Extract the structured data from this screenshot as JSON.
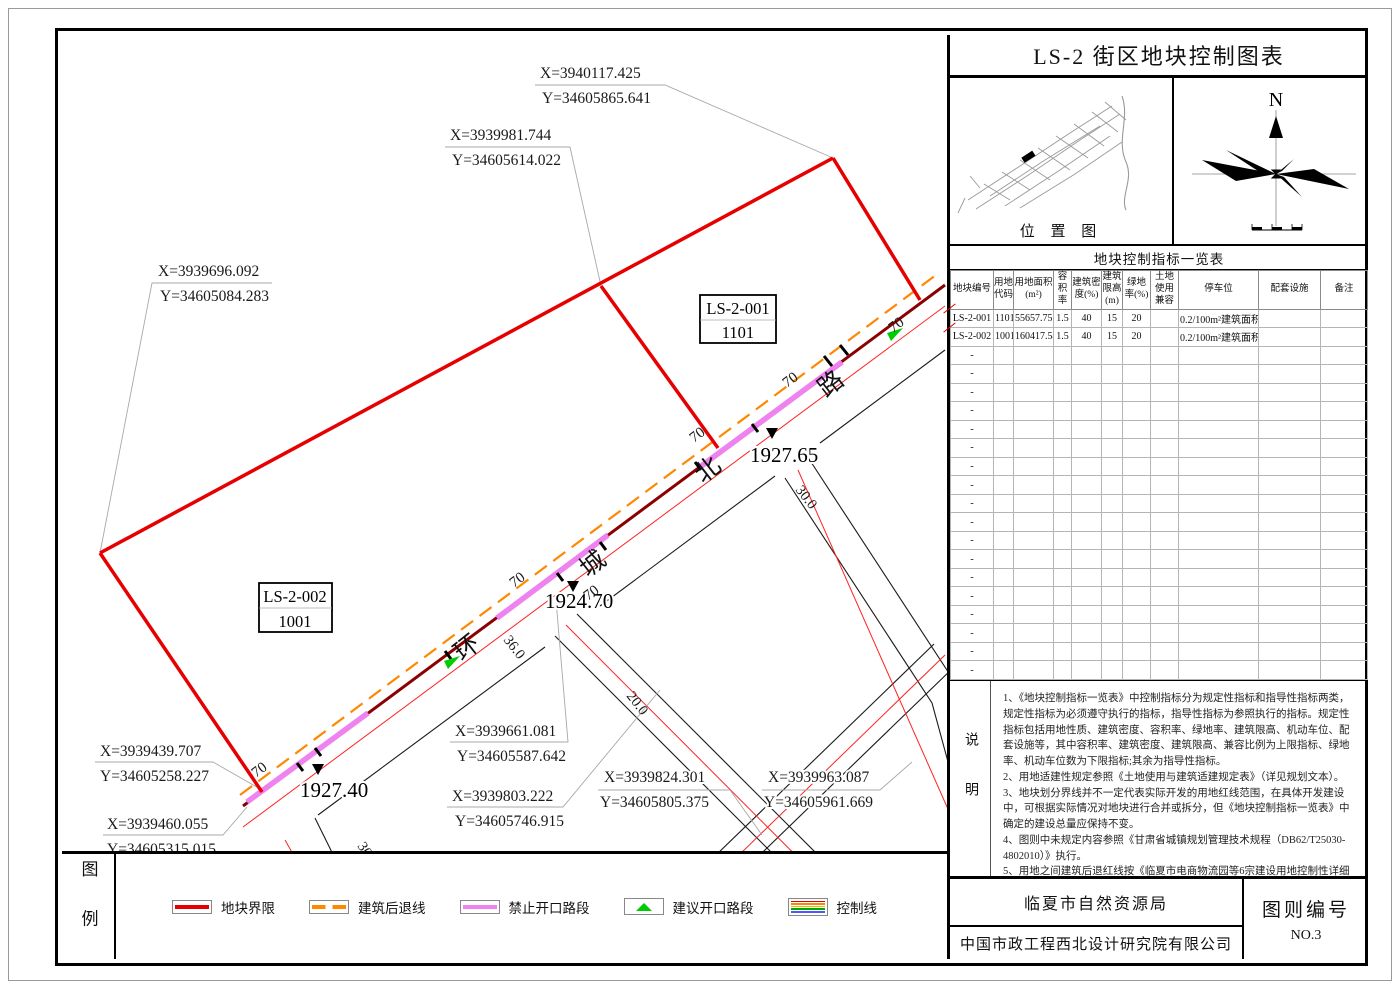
{
  "sheet": {
    "title": "LS-2 街区地块控制图表",
    "location_label": "位 置 图",
    "north_label": "N",
    "table_title": "地块控制指标一览表"
  },
  "table": {
    "headers": [
      "地块编号",
      "用地代码",
      "用地面积(m²)",
      "容积率",
      "建筑密度(%)",
      "建筑限高(m)",
      "绿地率(%)",
      "土地使用兼容",
      "停车位",
      "配套设施",
      "备注"
    ],
    "rows": [
      [
        "LS-2-001",
        "1101",
        "55657.75",
        "1.5",
        "40",
        "15",
        "20",
        "",
        "0.2/100m²建筑面积",
        "",
        ""
      ],
      [
        "LS-2-002",
        "1001",
        "160417.54",
        "1.5",
        "40",
        "15",
        "20",
        "",
        "0.2/100m²建筑面积",
        "",
        ""
      ]
    ],
    "empty_row_count": 18,
    "empty_placeholder": "-"
  },
  "notes": {
    "label": "说明",
    "lines": [
      "1、《地块控制指标一览表》中控制指标分为规定性指标和指导性指标两类，规定性指标为必须遵守执行的指标，指导性指标为参照执行的指标。规定性指标包括用地性质、建筑密度、容积率、绿地率、建筑限高、机动车位、配套设施等，其中容积率、建筑密度、建筑限高、兼容比例为上限指标、绿地率、机动车位数为下限指标;其余为指导性指标。",
      "2、用地适建性规定参照《土地使用与建筑适建规定表》（详见规划文本）。",
      "3、地块划分界线并不一定代表实际开发的用地红线范围，在具体开发建设中，可根据实际情况对地块进行合并或拆分，但《地块控制指标一览表》中确定的建设总量应保持不变。",
      "4、图则中未规定内容参照《甘肃省城镇规划管理技术规程（DB62/T25030-4802010）》执行。",
      "5、用地之间建筑后退红线按《临夏市电商物流园等6宗建设用地控制性详细规划》具体要求执行",
      "6、城市设计指引：建筑色彩在整体和谐的前提下，鼓励各单体建筑局部色彩多样化。",
      "工业建筑",
      "色彩要求素雅明快，强调环境色彩的和谐统一。",
      "基本色：以高明度、低饱和度的色系为主。",
      "辅助色：适当增加高明度、中饱和度的暖色调或冷灰色调。",
      "点缀色：增加色彩的变化，提高色彩的饱和度。"
    ]
  },
  "title_block": {
    "agency": "临夏市自然资源局",
    "company": "中国市政工程西北设计研究院有限公司",
    "sheet_no_label": "图则编号",
    "sheet_no": "NO.3"
  },
  "legend": {
    "label": "图例",
    "items": [
      {
        "label": "地块界限"
      },
      {
        "label": "建筑后退线"
      },
      {
        "label": "禁止开口路段"
      },
      {
        "label": "建议开口路段"
      },
      {
        "label": "控制线"
      }
    ]
  },
  "map": {
    "parcels": [
      {
        "id": "LS-2-001",
        "code": "1101"
      },
      {
        "id": "LS-2-002",
        "code": "1001"
      }
    ],
    "road_name": [
      "环",
      "城",
      "北",
      "路"
    ],
    "coordinates": [
      {
        "x": "X=3940117.425",
        "y": "Y=34605865.641"
      },
      {
        "x": "X=3939981.744",
        "y": "Y=34605614.022"
      },
      {
        "x": "X=3939696.092",
        "y": "Y=34605084.283"
      },
      {
        "x": "X=3939439.707",
        "y": "Y=34605258.227"
      },
      {
        "x": "X=3939460.055",
        "y": "Y=34605315.015"
      },
      {
        "x": "X=3939661.081",
        "y": "Y=34605587.642"
      },
      {
        "x": "X=3939803.222",
        "y": "Y=34605746.915"
      },
      {
        "x": "X=3939824.301",
        "y": "Y=34605805.375"
      },
      {
        "x": "X=3939963.087",
        "y": "Y=34605961.669"
      }
    ],
    "elevations": [
      "1927.65",
      "1924.70",
      "1927.40"
    ],
    "setback_width": "70",
    "road_widths": [
      "36.0",
      "30.0",
      "30.0",
      "20.0"
    ]
  },
  "colors": {
    "parcel_boundary": "#e60000",
    "setback_line": "#ff8800",
    "no_access": "#ee82ee",
    "suggested_access": "#00cc00",
    "control_dark_red": "#8b0000",
    "road_red_line": "#ff2222"
  }
}
